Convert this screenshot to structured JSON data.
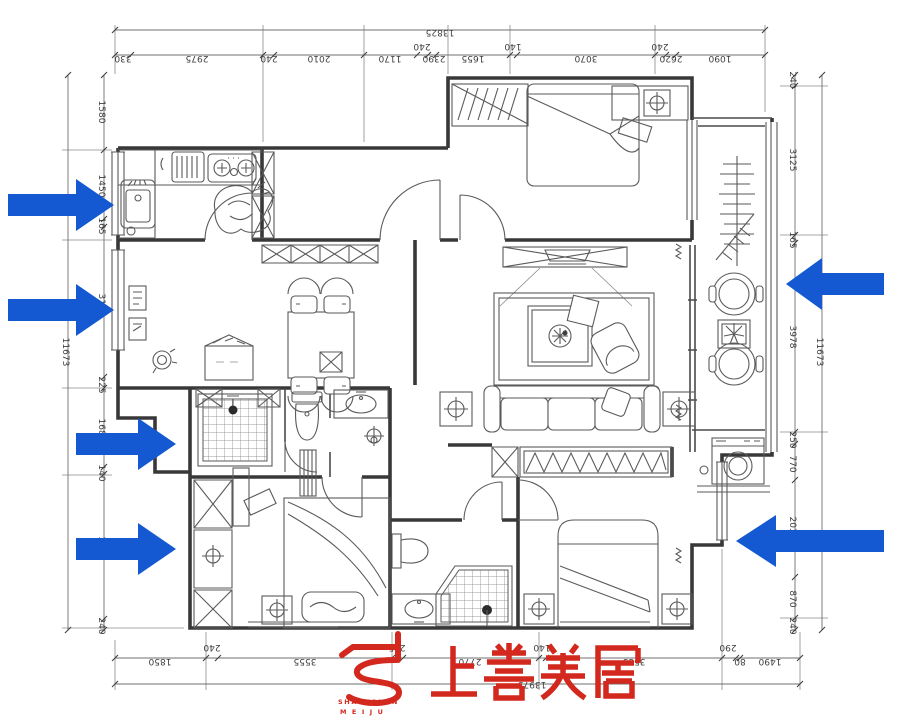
{
  "drawing": {
    "type": "floor-plan",
    "colors": {
      "line": "#3f3f3f",
      "arrow_blue": "#1459d2",
      "logo_red": "#d3281e"
    }
  },
  "dimensions": {
    "top": {
      "overall": "13825",
      "segments": [
        "330",
        "2975",
        "240",
        "2010",
        "1170",
        "240",
        "2390",
        "1655",
        "140",
        "3070",
        "240",
        "2620",
        "1090"
      ]
    },
    "bottom": {
      "overall": "13975",
      "segments": [
        "1850",
        "240",
        "3555",
        "235",
        "2770",
        "140",
        "3585",
        "290",
        "80",
        "1490"
      ]
    },
    "left": {
      "overall": "11673",
      "segments": [
        "1580",
        "1450",
        "165",
        "3153",
        "225",
        "1680",
        "140",
        "3040",
        "240"
      ]
    },
    "right": {
      "overall": "11673",
      "segments": [
        "240",
        "3125",
        "165",
        "3978",
        "250",
        "770",
        "2035",
        "870",
        "240"
      ]
    }
  },
  "logo": {
    "brand_cn": "上善美居",
    "brand_en_line1": "SHANGSHAN",
    "brand_en_line2": "M E I J U"
  },
  "arrows": {
    "count_left": 4,
    "count_right": 2,
    "color": "#1459d2"
  }
}
